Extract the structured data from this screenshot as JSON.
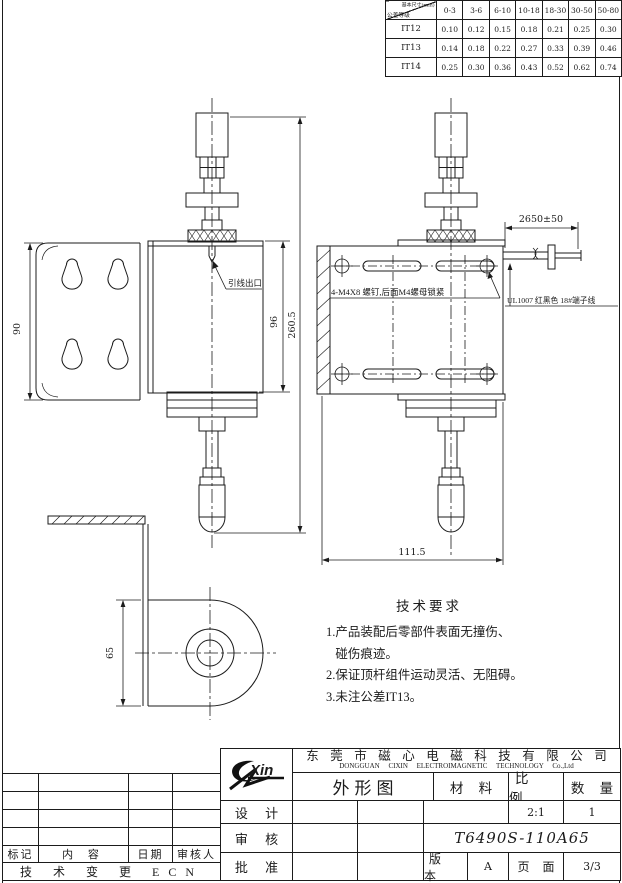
{
  "tolerance_table": {
    "corner_top": "基本尺寸(mm)",
    "corner_bottom": "公差等级",
    "size_ranges": [
      "0-3",
      "3-6",
      "6-10",
      "10-18",
      "18-30",
      "30-50",
      "50-80"
    ],
    "rows": [
      {
        "grade": "IT12",
        "values": [
          "0.10",
          "0.12",
          "0.15",
          "0.18",
          "0.21",
          "0.25",
          "0.30"
        ]
      },
      {
        "grade": "IT13",
        "values": [
          "0.14",
          "0.18",
          "0.22",
          "0.27",
          "0.33",
          "0.39",
          "0.46"
        ]
      },
      {
        "grade": "IT14",
        "values": [
          "0.25",
          "0.30",
          "0.36",
          "0.43",
          "0.52",
          "0.62",
          "0.74"
        ]
      }
    ]
  },
  "drawing": {
    "dims": {
      "bracket_height": "90",
      "body_height": "96",
      "overall_height": "260.5",
      "wire_length": "2650±50",
      "body_width": "111.5",
      "plate_height": "65"
    },
    "labels": {
      "lead_exit": "引线出口",
      "screws": "4-M4X8 螺钉,后面M4螺母锁紧",
      "wire": "UL1007 红黑色 18#端子线"
    }
  },
  "tech_req": {
    "title": "技术要求",
    "lines": [
      "1.产品装配后零部件表面无撞伤、",
      "   碰伤痕迹。",
      "2.保证顶杆组件运动灵活、无阻碍。",
      "3.未注公差IT13。"
    ]
  },
  "title_block": {
    "logo": "Xin",
    "company_cn": "东莞市磁心电磁科技有限公司",
    "company_en": "DONGGUAN  CIXIN  ELECTROIMAGNETIC  TECHNOLOGY  Co.,Ltd",
    "drawing_type": "外形图",
    "material_label": "材 料",
    "scale_label": "比 例",
    "qty_label": "数 量",
    "scale_value": "2:1",
    "qty_value": "1",
    "design_label": "设 计",
    "review_label": "审 核",
    "approve_label": "批 准",
    "part_number": "T6490S-110A65",
    "version_label": "版 本",
    "version_value": "A",
    "page_label": "页 面",
    "page_value": "3/3"
  },
  "revision_table": {
    "col_mark": "标记",
    "col_content": "内  容",
    "col_date": "日期",
    "col_auditor": "审核人",
    "footer": "技 术 变 更 ECN"
  }
}
